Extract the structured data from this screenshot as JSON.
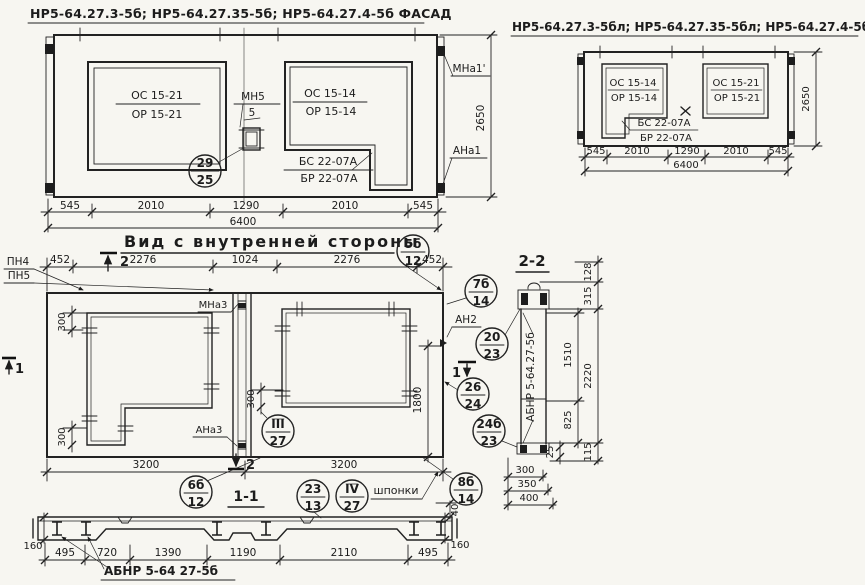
{
  "facade_left": {
    "title": "НР5-64.27.3-5б; НР5-64.27.35-5б; НР5-64.27.4-5б   ФАСАД",
    "window_left": {
      "line1": "ОС 15-21",
      "line2": "ОР 15-21"
    },
    "window_right": {
      "line1": "ОС 15-14",
      "line2": "ОР 15-14"
    },
    "apron": {
      "line1": "БС 22-07А",
      "line2": "БР 22-07А"
    },
    "hinge_label": "МН5",
    "hinge_no": "5",
    "callout": {
      "top": "29",
      "bottom": "25"
    },
    "anchor_top": "МНа1'",
    "anchor_bottom": "АНа1",
    "height": "2650",
    "dims": [
      "545",
      "2010",
      "1290",
      "2010",
      "545"
    ],
    "total": "6400"
  },
  "facade_right": {
    "title": "НР5-64.27.3-5бл; НР5-64.27.35-5бл; НР5-64.27.4-5б ФАСАД",
    "window_left": {
      "line1": "ОС 15-14",
      "line2": "ОР 15-14"
    },
    "window_right": {
      "line1": "ОС 15-21",
      "line2": "ОР 15-21"
    },
    "apron": {
      "line1": "БС 22-07А",
      "line2": "БР 22-07А"
    },
    "height": "2650",
    "dims": [
      "545",
      "2010",
      "1290",
      "2010",
      "545"
    ],
    "total": "6400"
  },
  "inner_view": {
    "title": "Вид с внутренней стороны",
    "dims_top": [
      "452",
      "2276",
      "1024",
      "2276",
      "452"
    ],
    "dims_bottom": [
      "3200",
      "3200"
    ],
    "dims_300": [
      "300",
      "300",
      "300"
    ],
    "dim_1800": "1800",
    "pn4": "ПН4",
    "pn5": "ПН5",
    "mna3": "МНа3",
    "ana3": "АНа3",
    "an2": "АН2",
    "marker_1": "1",
    "marker_2": "2",
    "shponki": "шпонки",
    "callouts": {
      "c5b12": {
        "top": "5б",
        "bottom": "12"
      },
      "c7b14": {
        "top": "7б",
        "bottom": "14"
      },
      "c2023": {
        "top": "20",
        "bottom": "23"
      },
      "c2624": {
        "top": "26",
        "bottom": "24"
      },
      "c24b23": {
        "top": "24б",
        "bottom": "23"
      },
      "c8b14": {
        "top": "8б",
        "bottom": "14"
      },
      "c6b12": {
        "top": "6б",
        "bottom": "12"
      },
      "c327": {
        "top": "III",
        "bottom": "27"
      },
      "c2313": {
        "top": "23",
        "bottom": "13"
      },
      "c427": {
        "top": "IV",
        "bottom": "27"
      }
    }
  },
  "section_2_2": {
    "title": "2-2",
    "panel_label": "АБНР 5-64.27-5б",
    "dim_128": "128",
    "dim_315": "315",
    "dim_1510": "1510",
    "dim_2220": "2220",
    "dim_825": "825",
    "dim_25": "25",
    "dim_115": "115",
    "dims_bottom": [
      "300",
      "350",
      "400"
    ]
  },
  "section_1_1": {
    "title": "1-1",
    "dims": [
      "495",
      "720",
      "1390",
      "1190",
      "2110",
      "495"
    ],
    "dim_160_left": "160",
    "dim_160_right": "160",
    "dim_40": "40",
    "label": "АБНР 5-64 27-5б"
  }
}
